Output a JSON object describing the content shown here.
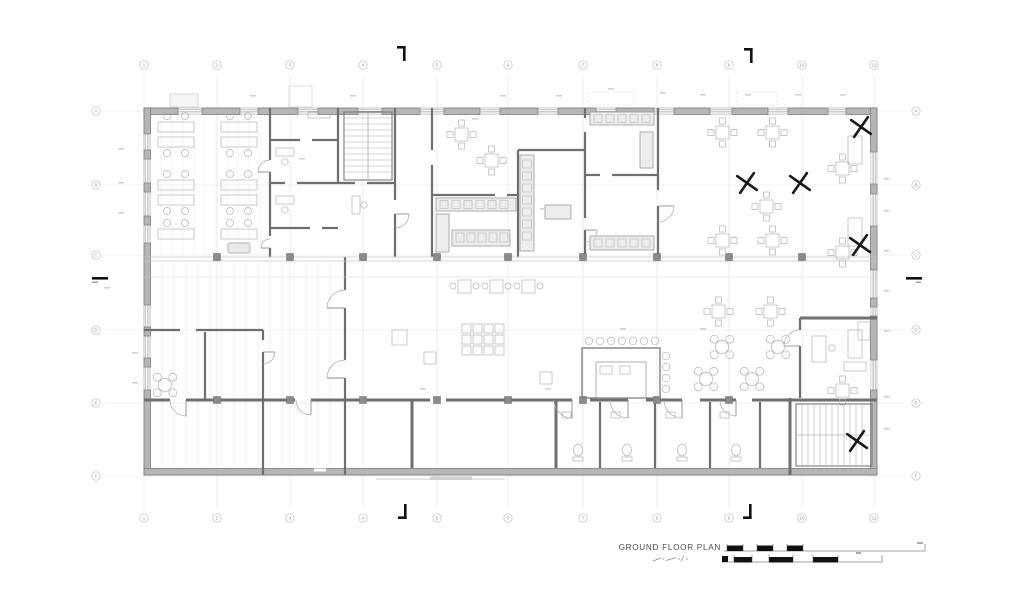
{
  "drawing": {
    "title": "GROUND FLOOR PLAN",
    "grid": {
      "column_labels": [
        "1",
        "2",
        "3",
        "4",
        "5",
        "6",
        "7",
        "8",
        "9",
        "10",
        "11"
      ],
      "row_labels": [
        "A",
        "B",
        "C",
        "D",
        "E",
        "F"
      ]
    },
    "right_wall_window_label": "2m",
    "colors": {
      "background": "#ffffff",
      "wall_fill": "#b6b6b6",
      "wall_stroke": "#757575",
      "interior_wall": "#6f6f6f",
      "light_wall": "#c4c4c4",
      "furniture": "#b3b3b3",
      "counter_fill": "#ededed",
      "grid_line": "#e2e2e2",
      "bubble_stroke": "#bcbcbc",
      "label": "#8f8f8f",
      "fan": "#1a1a1a",
      "section_marker": "#111111",
      "title": "#4d4d4d",
      "scale_bar": "#111111"
    }
  }
}
